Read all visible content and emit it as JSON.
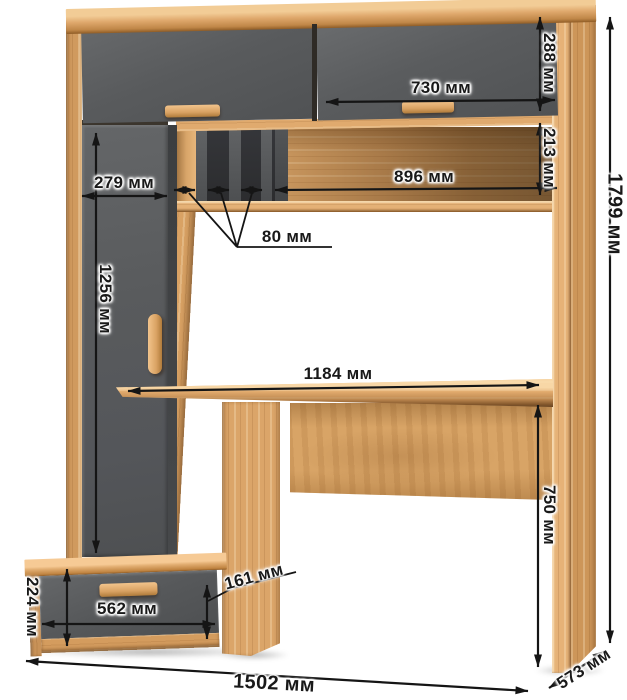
{
  "page": {
    "type": "furniture-dimension-diagram",
    "subject": "Computer desk with hutch, wardrobe column and drawer pedestal",
    "background": "#ffffff",
    "unit": "мм"
  },
  "palette": {
    "wood_light": "#dca56a",
    "wood_bright": "#f2c48c",
    "wood_dark": "#b9823f",
    "front_gray": "#595b5d",
    "slot_dark": "#2e2f31",
    "dimension_line": "#151515",
    "label_text": "#191919"
  },
  "labels": {
    "top_door_height": "288 мм",
    "top_door_width": "730 мм",
    "open_shelf_height": "213 мм",
    "open_shelf_width": "896 мм",
    "cabinet_width": "279 мм",
    "slot_width": "80 мм",
    "cabinet_door_height": "1256 мм",
    "desktop_width": "1184 мм",
    "desk_height": "750 мм",
    "overall_height": "1799 мм",
    "drawer_height": "161 мм",
    "drawer_width": "562 мм",
    "drawer_unit_height": "224 мм",
    "overall_width": "1502 мм",
    "depth": "573 мм"
  },
  "measurements_mm": [
    {
      "label": "288 мм",
      "value": 288,
      "part": "upper right cabinet door height"
    },
    {
      "label": "730 мм",
      "value": 730,
      "part": "upper right cabinet door width"
    },
    {
      "label": "213 мм",
      "value": 213,
      "part": "open shelf niche height"
    },
    {
      "label": "896 мм",
      "value": 896,
      "part": "open shelf niche width"
    },
    {
      "label": "279 мм",
      "value": 279,
      "part": "left cabinet column width"
    },
    {
      "label": "80 мм",
      "value": 80,
      "part": "pigeonhole slot width"
    },
    {
      "label": "1256 мм",
      "value": 1256,
      "part": "left cabinet door height"
    },
    {
      "label": "1184 мм",
      "value": 1184,
      "part": "desktop width"
    },
    {
      "label": "750 мм",
      "value": 750,
      "part": "desktop height from floor"
    },
    {
      "label": "1799 мм",
      "value": 1799,
      "part": "overall height"
    },
    {
      "label": "161 мм",
      "value": 161,
      "part": "drawer front height"
    },
    {
      "label": "562 мм",
      "value": 562,
      "part": "drawer front width"
    },
    {
      "label": "224 мм",
      "value": 224,
      "part": "drawer pedestal height"
    },
    {
      "label": "1502 мм",
      "value": 1502,
      "part": "overall width"
    },
    {
      "label": "573 мм",
      "value": 573,
      "part": "depth"
    }
  ]
}
